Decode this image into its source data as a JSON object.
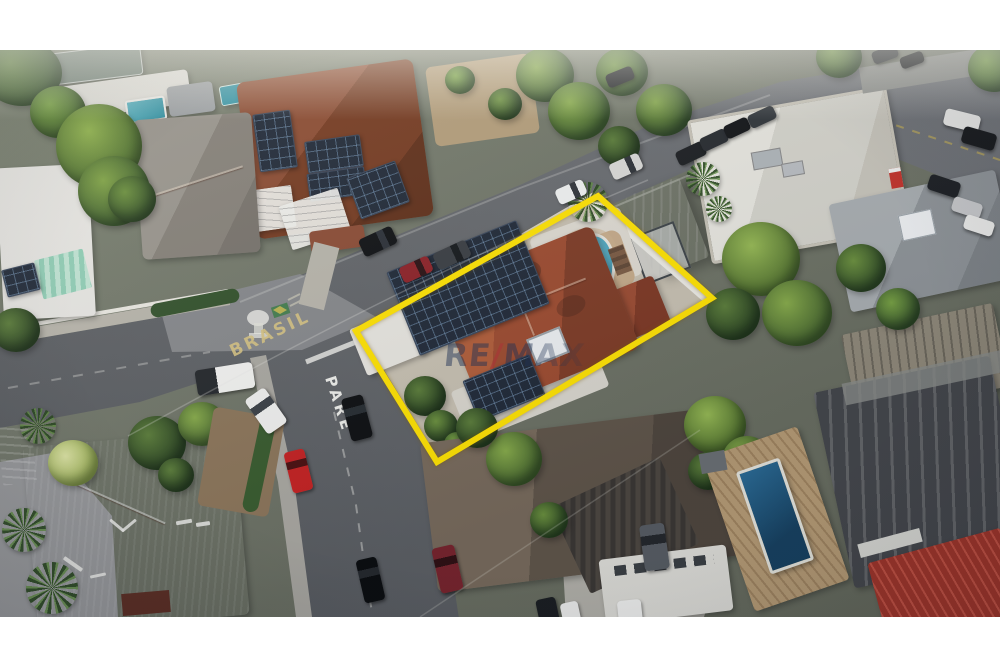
{
  "photo": {
    "kind": "aerial-drone-photo-of-residential-property",
    "letterbox_color": "#FFFFFF",
    "watermark": {
      "part1": "RE",
      "slash": "/",
      "part2": "MAX"
    },
    "street_art": {
      "brasil_text": "BRASIL"
    },
    "road_markings": {
      "stop_text": "PARE"
    },
    "highlight": {
      "shape": "quadrilateral",
      "color": "#FFE200"
    },
    "palette": {
      "asphalt": "#5E6165",
      "concrete": "#B7B4AA",
      "tile_roof_red": "#9C4A2E",
      "neighbor_roof_brown": "#7A3B26",
      "solar_panel": "#1F2836",
      "kidney_pool_blue": "#4FA8C0",
      "lap_pool_blue": "#1E4E78",
      "small_pool_teal": "#2F8FA0",
      "tarp_blue": "#2F6FD0",
      "vegetation_dark": "#2E4A24",
      "vegetation_bright": "#7FA344",
      "white_roof": "#E8E7E2",
      "weathered_roof": "#5A5A5C",
      "industrial_roof": "#44464A",
      "corrugated_red_roof": "#A03428",
      "wood_deck": "#B59A73",
      "dirt_yard": "#B29C79",
      "watermark_text": "#1B2E52",
      "watermark_slash": "#B03032",
      "street_text": "#D6C382",
      "stop_text": "#EEEEEA"
    }
  }
}
